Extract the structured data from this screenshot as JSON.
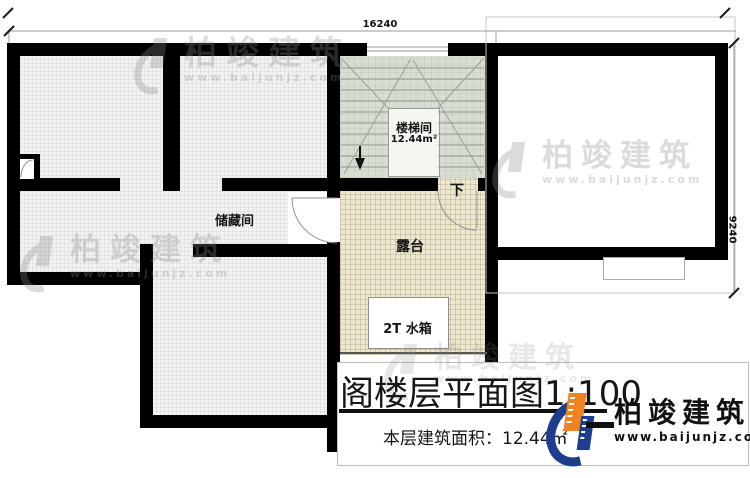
{
  "colors": {
    "wall": "#000000",
    "stair_floor": "#d8dfd2",
    "terrace_floor": "#ece7d2",
    "storage_floor": "#f2f2f0",
    "brand_orange": "#f08220",
    "brand_blue": "#1d3e8f"
  },
  "dimensions": {
    "top": "16240",
    "right": "9240"
  },
  "rooms": {
    "storage": "储藏间",
    "stairwell": "楼梯间",
    "stairwell_area": "12.44m²",
    "terrace": "露台",
    "water_tank": "2T 水箱",
    "stair_down": "下"
  },
  "title_block": {
    "title": "阁楼层平面图1:100",
    "area": "本层建筑面积：12.44㎡"
  },
  "brand": {
    "name": "柏竣建筑",
    "url": "www.baijunjz.com"
  }
}
